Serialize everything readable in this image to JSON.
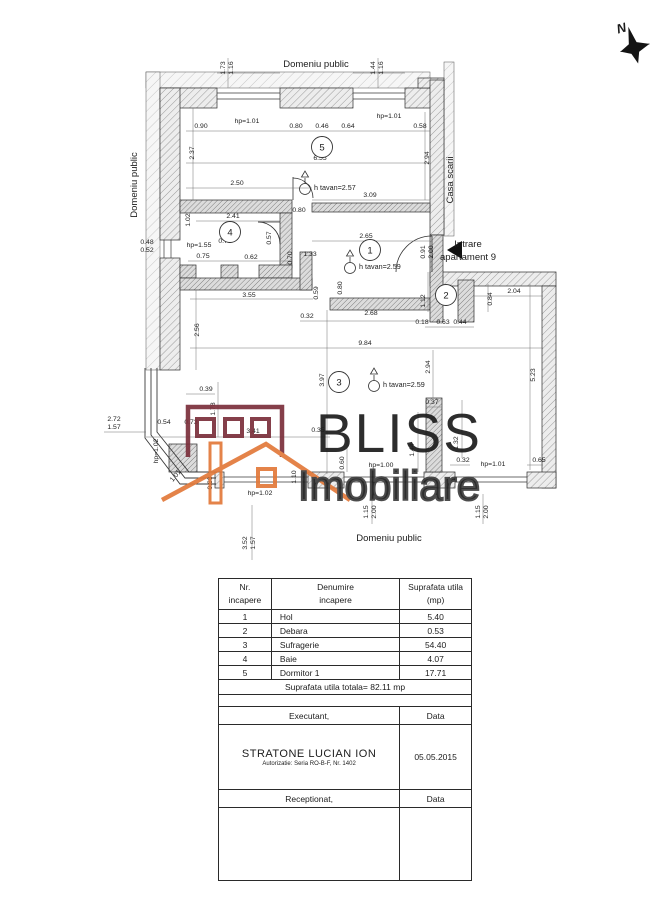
{
  "plan": {
    "dims": [
      "1.73",
      "1.16",
      "1.44",
      "1.16",
      "0.90",
      "hp=1.01",
      "0.80",
      "0.46",
      "0.64",
      "hp=1.01",
      "0.58",
      "2.37",
      "6.55",
      "2.94",
      "2.50",
      "3.09",
      "0.80",
      "2.41",
      "1.02",
      "hp=1.55",
      "0.73",
      "0.75",
      "0.62",
      "0.57",
      "0.48",
      "0.52",
      "2.65",
      "0.91",
      "2.00",
      "0.70",
      "1.33",
      "3.55",
      "0.59",
      "0.80",
      "0.32",
      "2.68",
      "0.18",
      "0.63",
      "0.44",
      "1.12",
      "0.84",
      "2.04",
      "2.56",
      "9.84",
      "2.94",
      "3.97",
      "5.23",
      "0.39",
      "1.78",
      "2.72",
      "1.57",
      "0.54",
      "0.73",
      "3.41",
      "0.35",
      "hp=1.02",
      "1.01",
      "0.88",
      "1.10",
      "hp=1.02",
      "0.37",
      "1.44",
      "1.32",
      "0.60",
      "hp=1.00",
      "0.32",
      "hp=1.01",
      "0.65",
      "2.00",
      "1.15",
      "2.00",
      "1.15",
      "3.52",
      "1.57"
    ],
    "rooms": [
      {
        "number": "5",
        "ceiling": "h tavan=2.57"
      },
      {
        "number": "4",
        "ceiling": ""
      },
      {
        "number": "1",
        "ceiling": "h tavan=2.59"
      },
      {
        "number": "2",
        "ceiling": ""
      },
      {
        "number": "3",
        "ceiling": "h tavan=2.59"
      }
    ],
    "labels": {
      "domeniu_top": "Domeniu public",
      "domeniu_left": "Domeniu public",
      "domeniu_bottom": "Domeniu public",
      "casa_scarii": "Casa scarii",
      "intrare_line1": "Intrare",
      "intrare_line2": "apartament 9",
      "compass_n": "N"
    }
  },
  "watermark": {
    "line1": "BLISS",
    "line2": "Imobiliare"
  },
  "colors": {
    "watermark": "#3d3d3d",
    "logo_maroon": "#7b2f3b",
    "logo_orange": "#e2793a"
  },
  "table": {
    "headers": {
      "col1_line1": "Nr.",
      "col1_line2": "incapere",
      "col2_line1": "Denumire",
      "col2_line2": "incapere",
      "col3_line1": "Suprafata utila",
      "col3_line2": "(mp)"
    },
    "rows": [
      [
        "1",
        "Hol",
        "5.40"
      ],
      [
        "2",
        "Debara",
        "0.53"
      ],
      [
        "3",
        "Sufragerie",
        "54.40"
      ],
      [
        "4",
        "Baie",
        "4.07"
      ],
      [
        "5",
        "Dormitor 1",
        "17.71"
      ]
    ],
    "total": "Suprafata utila totala= 82.11 mp",
    "executant_label": "Executant,",
    "data_label": "Data",
    "executant_name": "STRATONE LUCIAN ION",
    "executant_auth": "Autorizatie: Seria RO-B-F, Nr. 1402",
    "date_value": "05.05.2015",
    "receptionat_label": "Receptionat,",
    "data_label2": "Data"
  }
}
